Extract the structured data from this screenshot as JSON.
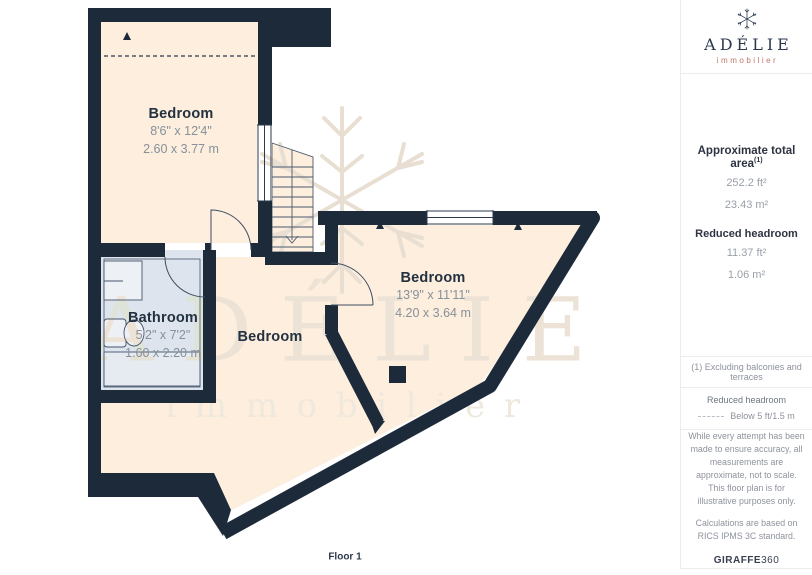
{
  "plan": {
    "floor_label": "Floor 1",
    "rooms": [
      {
        "name": "Bedroom",
        "dims_ft": "8'6\" x 12'4\"",
        "dims_m": "2.60 x 3.77 m"
      },
      {
        "name": "Bedroom",
        "dims_ft": "13'9\" x 11'11\"",
        "dims_m": "4.20 x 3.64 m"
      },
      {
        "name": "Bathroom",
        "dims_ft": "5'2\" x 7'2\"",
        "dims_m": "1.60 x 2.20 m"
      },
      {
        "name": "Bedroom"
      }
    ],
    "colors": {
      "wall": "#1d2a3a",
      "floor": "#fdeedd",
      "bathroom_floor": "#dde4ed"
    }
  },
  "watermark": {
    "line1": "ADÉLIE",
    "line2": "immobilier"
  },
  "sidebar": {
    "brand": {
      "name": "ADÉLIE",
      "tagline": "immobilier",
      "accent": "#bf7668",
      "navy": "#2c3a50"
    },
    "area": {
      "title": "Approximate total area",
      "superscript": "(1)",
      "values": [
        "252.2 ft²",
        "23.43 m²"
      ],
      "headroom_title": "Reduced headroom",
      "headroom_values": [
        "11.37 ft²",
        "1.06 m²"
      ]
    },
    "footnote": "(1) Excluding balconies and terraces",
    "legend": {
      "title": "Reduced headroom",
      "item": "Below 5 ft/1.5 m"
    },
    "disclaimer": "While every attempt has been made to ensure accuracy, all measurements are approximate, not to scale. This floor plan is for illustrative purposes only.",
    "standard": "Calculations are based on RICS IPMS 3C standard.",
    "brand_footer": {
      "bold": "GIRAFFE",
      "rest": "360"
    }
  }
}
